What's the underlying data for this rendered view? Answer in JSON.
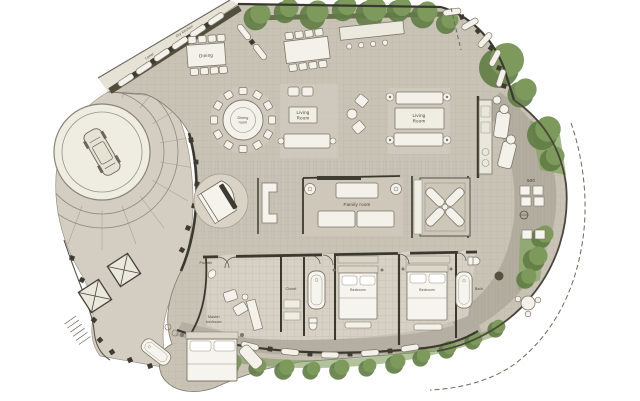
{
  "labels": {
    "dry_kitchen": "Dry kitchen",
    "lanai": "Lanai",
    "dining": "Dining",
    "round_table": {
      "line1": "Dining",
      "line2": "room"
    },
    "living_center": {
      "line1": "Living",
      "line2": "Room"
    },
    "living_right": {
      "line1": "Living",
      "line2": "Room"
    },
    "family_room": "Family room",
    "powder": "Powder",
    "closet": "Closet",
    "bedroom_center": "Bedroom",
    "bedroom_right": "Bedroom",
    "bath_right": "Bath",
    "master": {
      "line1": "Master",
      "line2": "bedroom"
    },
    "dim_500": "500"
  },
  "colors": {
    "background": "#ffffff",
    "floor": "#c9c3b6",
    "floor_light": "#d8d3c7",
    "terrace": "#b3ada0",
    "wall_dark": "#3b3830",
    "wall_olive": "#514e3d",
    "vegetation": "#7d9a5c",
    "vegetation_dark": "#5f7c44",
    "furniture_white": "#f3f1e9",
    "label_text": "#4a4436"
  }
}
